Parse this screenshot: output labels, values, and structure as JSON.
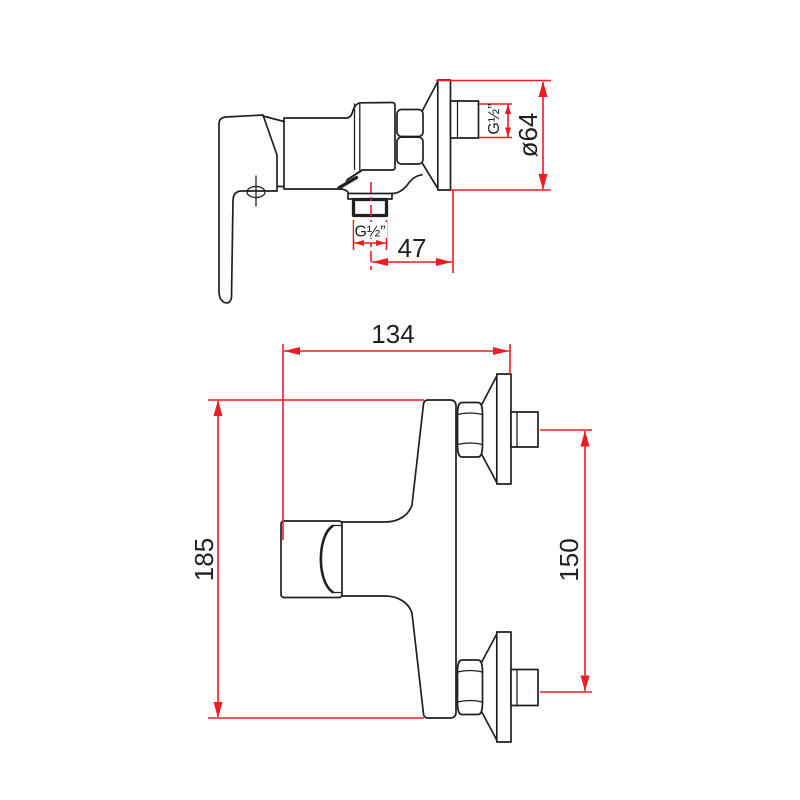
{
  "drawing": {
    "description": "Wall-mounted single-lever shower mixer technical dimension drawing, two orthographic views",
    "colors": {
      "line": "#231f20",
      "dimension_red": "#ed1c24",
      "background": "#ffffff"
    },
    "views": {
      "side": {
        "label": "side-view",
        "dimensions": {
          "flange_diameter": "ø64",
          "wall_connector_thread": "G½”",
          "outlet_thread": "G½”",
          "outlet_to_wall": "47"
        }
      },
      "front": {
        "label": "front-view",
        "dimensions": {
          "overall_width": "134",
          "overall_height": "185",
          "connector_spacing": "150"
        }
      }
    }
  }
}
